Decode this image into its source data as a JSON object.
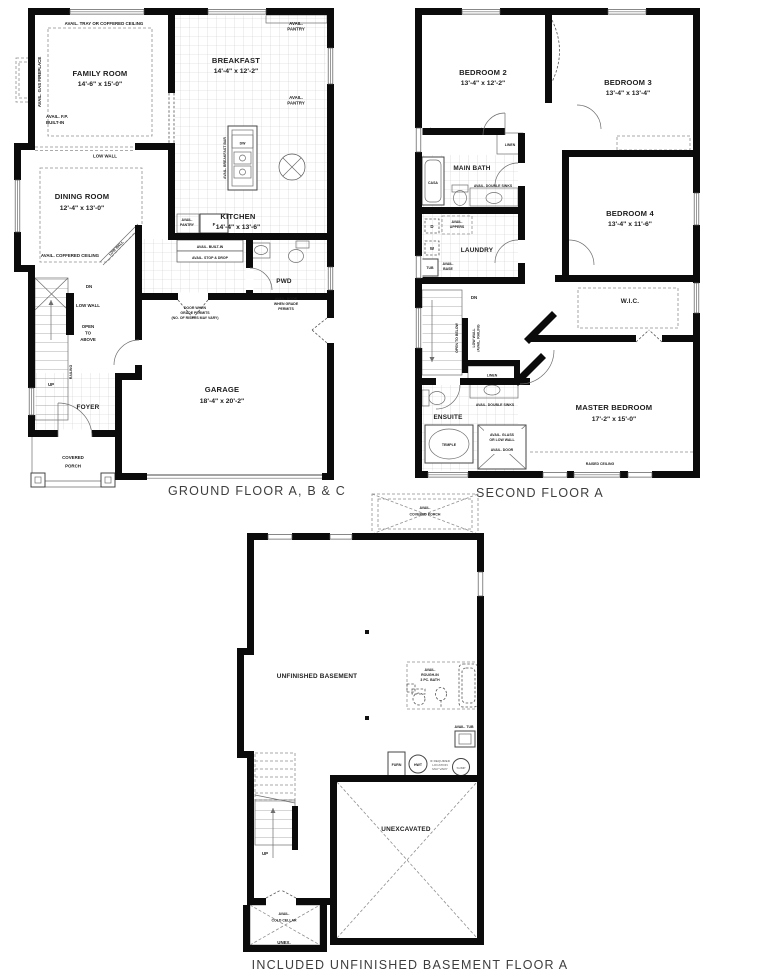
{
  "colors": {
    "wall": "#0b0b0b",
    "thin_line": "#6e6e6e",
    "tile_grid": "#cdcdcd",
    "caption_text": "#3d3d3d",
    "label_text": "#1d1d1d"
  },
  "plans": {
    "ground": {
      "caption": "GROUND FLOOR A, B & C",
      "rooms": {
        "family": {
          "name": "FAMILY ROOM",
          "dims": "14'-6\" x 15'-0\""
        },
        "breakfast": {
          "name": "BREAKFAST",
          "dims": "14'-4\" x 12'-2\""
        },
        "kitchen": {
          "name": "KITCHEN",
          "dims": "14'-4\" x 13'-6\""
        },
        "dining": {
          "name": "DINING ROOM",
          "dims": "12'-4\" x 13'-0\""
        },
        "garage": {
          "name": "GARAGE",
          "dims": "18'-4\" x 20'-2\""
        },
        "foyer": "FOYER",
        "pwd": "PWD",
        "covered_porch": "COVERED\nPORCH"
      },
      "notes": {
        "tray_ceiling": "AVAIL. TRAY OR COFFERED CEILING",
        "gas_fireplace": "AVAIL. GAS FIREPLACE",
        "fp_builtin": "AVAIL. F.P.\nBUILT-IN",
        "low_wall": "LOW WALL",
        "coffered_ceiling": "AVAIL. COFFERED CEILING",
        "pantry": "AVAIL.\nPANTRY",
        "breakfast_bar": "AVAIL. BREAKFAST BAR",
        "builtin": "AVAIL. BUILT-IN",
        "stop_drop": "AVAIL. STOP & DROP",
        "open_above": "OPEN\nTO\nABOVE",
        "railing": "RAILING",
        "dn": "DN",
        "up": "UP",
        "door_grade": "DOOR WHEN\nGRADE PERMITS\n(NO. OF RISERS MAY VARY)",
        "avail_door_grade": "AVAIL. DOOR\nWHEN GRADE\nPERMITS"
      },
      "fixtures": {
        "dw": "DW",
        "fridge": "F"
      }
    },
    "second": {
      "caption": "SECOND FLOOR A",
      "rooms": {
        "bed2": {
          "name": "BEDROOM 2",
          "dims": "13'-4\" x 12'-2\""
        },
        "bed3": {
          "name": "BEDROOM 3",
          "dims": "13'-4\" x 13'-4\""
        },
        "bed4": {
          "name": "BEDROOM 4",
          "dims": "13'-4\" x 11'-6\""
        },
        "master": {
          "name": "MASTER BEDROOM",
          "dims": "17'-2\" x 15'-0\""
        },
        "main_bath": "MAIN BATH",
        "laundry": "LAUNDRY",
        "ensuite": "ENSUITE",
        "wic": "W.I.C.",
        "linen": "LINEN"
      },
      "notes": {
        "double_sinks": "AVAIL. DOUBLE SINKS",
        "uppers": "AVAIL.\nUPPERS",
        "base": "AVAIL.\nBASE",
        "open_below": "OPEN TO BELOW",
        "low_wall_railing": "LOW WALL\n/AVAIL. RAILING",
        "dn": "DN",
        "glass_low_wall": "AVAIL. GLASS\nOR LOW WALL",
        "avail_door": "AVAIL. DOOR",
        "raised_ceiling": "RAISED CEILING"
      },
      "fixtures": {
        "casa_tub": "CASA",
        "temple_tub": "TEMPLE",
        "tub": "TUB",
        "washer": "W",
        "dryer": "D"
      }
    },
    "basement": {
      "caption": "INCLUDED UNFINISHED BASEMENT FLOOR A",
      "rooms": {
        "unfinished": "UNFINISHED BASEMENT",
        "unexcavated": "UNEXCAVATED",
        "cold_cellar": "AVAIL.\nCOLD CELLAR",
        "unex": "UNEX."
      },
      "notes": {
        "covered_porch": "AVAIL.\nCOVERED PORCH",
        "rough_in": "AVAIL.\nROUGH-IN\n3 PC. BATH",
        "avail_tub": "AVAIL. TUB",
        "if_required": "IF REQUIRED\nLOCATION\nMAY VARY",
        "up": "UP"
      },
      "fixtures": {
        "furn": "FURN",
        "hwt": "HWT",
        "sump": "SUMP"
      }
    }
  }
}
